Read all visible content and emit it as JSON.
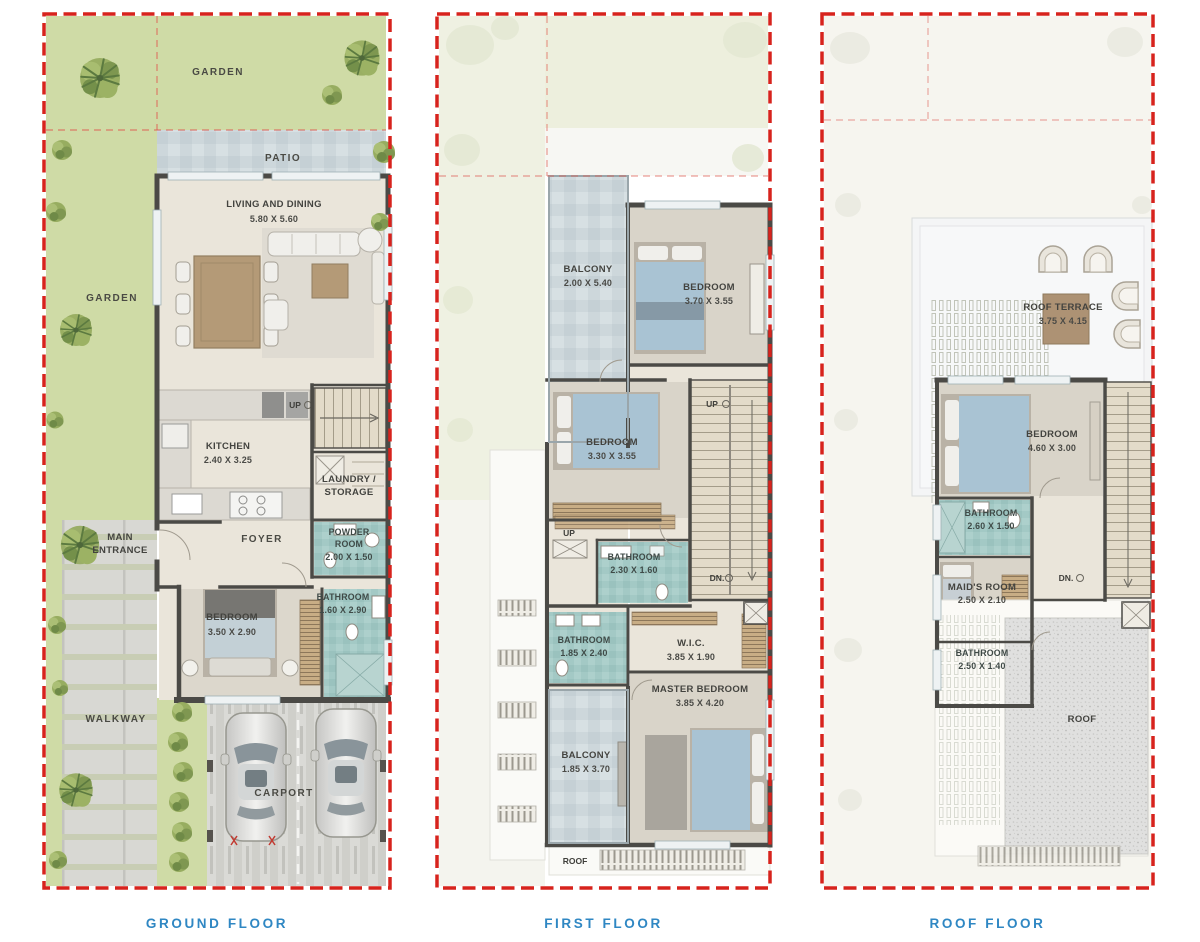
{
  "sheet": {
    "type": "townhouse-floor-plans",
    "panel_count": 3
  },
  "colors": {
    "plot_boundary_red": "#d7231d",
    "caption_blue": "#2f87c3",
    "garden_green": "#cfdba6",
    "tile_blue_grey": "#ccd6da",
    "bathroom_teal": "#a3c9c5",
    "floor_beige": "#e9e4d8",
    "wall_dark": "#4b4a46"
  },
  "floors": [
    {
      "caption": "GROUND FLOOR",
      "rooms": {
        "garden_top": {
          "lines": [
            "GARDEN"
          ]
        },
        "patio": {
          "lines": [
            "PATIO"
          ]
        },
        "living": {
          "lines": [
            "LIVING AND DINING",
            "5.80 X 5.60"
          ]
        },
        "garden_left": {
          "lines": [
            "GARDEN"
          ]
        },
        "kitchen": {
          "lines": [
            "KITCHEN",
            "2.40 X 3.25"
          ]
        },
        "stairs_up": {
          "lines": [
            "UP"
          ]
        },
        "laundry": {
          "lines": [
            "LAUNDRY /",
            "STORAGE"
          ]
        },
        "main_entrance": {
          "lines": [
            "MAIN",
            "ENTRANCE"
          ]
        },
        "foyer": {
          "lines": [
            "FOYER"
          ]
        },
        "powder_room": {
          "lines": [
            "POWDER",
            "ROOM",
            "2.00 X 1.50"
          ]
        },
        "bedroom": {
          "lines": [
            "BEDROOM",
            "3.50 X 2.90"
          ]
        },
        "bathroom": {
          "lines": [
            "BATHROOM",
            "1.60 X 2.90"
          ]
        },
        "walkway": {
          "lines": [
            "WALKWAY"
          ]
        },
        "carport": {
          "lines": [
            "CARPORT"
          ]
        }
      }
    },
    {
      "caption": "FIRST FLOOR",
      "rooms": {
        "balcony_top": {
          "lines": [
            "BALCONY",
            "2.00 X 5.40"
          ]
        },
        "bedroom_top": {
          "lines": [
            "BEDROOM",
            "3.70 X 3.55"
          ]
        },
        "bedroom_mid": {
          "lines": [
            "BEDROOM",
            "3.30 X 3.55"
          ]
        },
        "stairs_up": {
          "lines": [
            "UP"
          ]
        },
        "steps_up": {
          "lines": [
            "UP"
          ]
        },
        "bathroom_mid": {
          "lines": [
            "BATHROOM",
            "2.30 X 1.60"
          ]
        },
        "stairs_dn": {
          "lines": [
            "DN."
          ]
        },
        "bathroom_left": {
          "lines": [
            "BATHROOM",
            "1.85 X 2.40"
          ]
        },
        "wic": {
          "lines": [
            "W.I.C.",
            "3.85 X 1.90"
          ]
        },
        "master_bedroom": {
          "lines": [
            "MASTER BEDROOM",
            "3.85 X 4.20"
          ]
        },
        "balcony_bottom": {
          "lines": [
            "BALCONY",
            "1.85 X 3.70"
          ]
        },
        "roof_strip": {
          "lines": [
            "ROOF"
          ]
        }
      }
    },
    {
      "caption": "ROOF FLOOR",
      "rooms": {
        "roof_terrace": {
          "lines": [
            "ROOF TERRACE",
            "3.75 X 4.15"
          ]
        },
        "bedroom": {
          "lines": [
            "BEDROOM",
            "4.60 X 3.00"
          ]
        },
        "bathroom_top": {
          "lines": [
            "BATHROOM",
            "2.60 X 1.50"
          ]
        },
        "maids_room": {
          "lines": [
            "MAID'S ROOM",
            "2.50 X 2.10"
          ]
        },
        "stairs_dn": {
          "lines": [
            "DN."
          ]
        },
        "bathroom_bottom": {
          "lines": [
            "BATHROOM",
            "2.50 X 1.40"
          ]
        },
        "roof": {
          "lines": [
            "ROOF"
          ]
        }
      }
    }
  ]
}
